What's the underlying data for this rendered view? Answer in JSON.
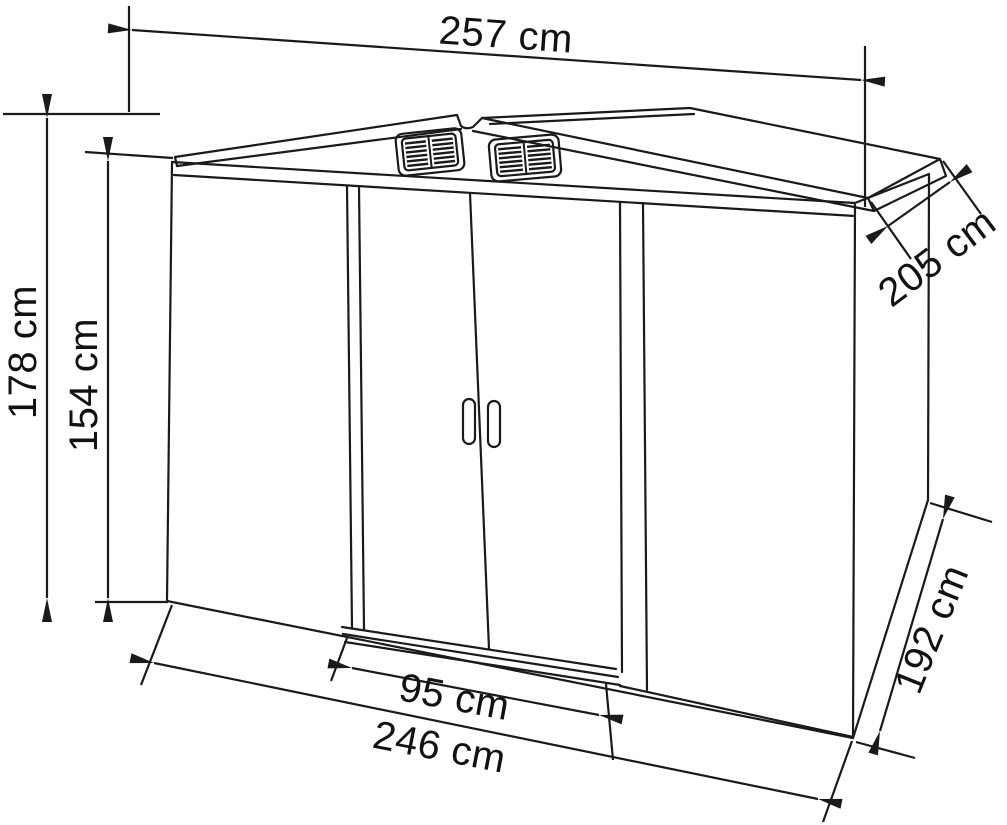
{
  "colors": {
    "background": "#ffffff",
    "line": "#1a1a1a",
    "text": "#111111"
  },
  "diagram": {
    "type": "product dimension line drawing",
    "subject": "Metal garden shed with gable roof, two roof vents and double sliding doors",
    "dimensions": {
      "overall_width": {
        "value": 257,
        "unit": "cm",
        "label": "257 cm"
      },
      "overall_height": {
        "value": 178,
        "unit": "cm",
        "label": "178 cm"
      },
      "wall_height": {
        "value": 154,
        "unit": "cm",
        "label": "154 cm"
      },
      "roof_depth": {
        "value": 205,
        "unit": "cm",
        "label": "205 cm"
      },
      "door_opening_width": {
        "value": 95,
        "unit": "cm",
        "label": "95 cm"
      },
      "base_width": {
        "value": 246,
        "unit": "cm",
        "label": "246 cm"
      },
      "base_depth": {
        "value": 192,
        "unit": "cm",
        "label": "192 cm"
      }
    }
  }
}
